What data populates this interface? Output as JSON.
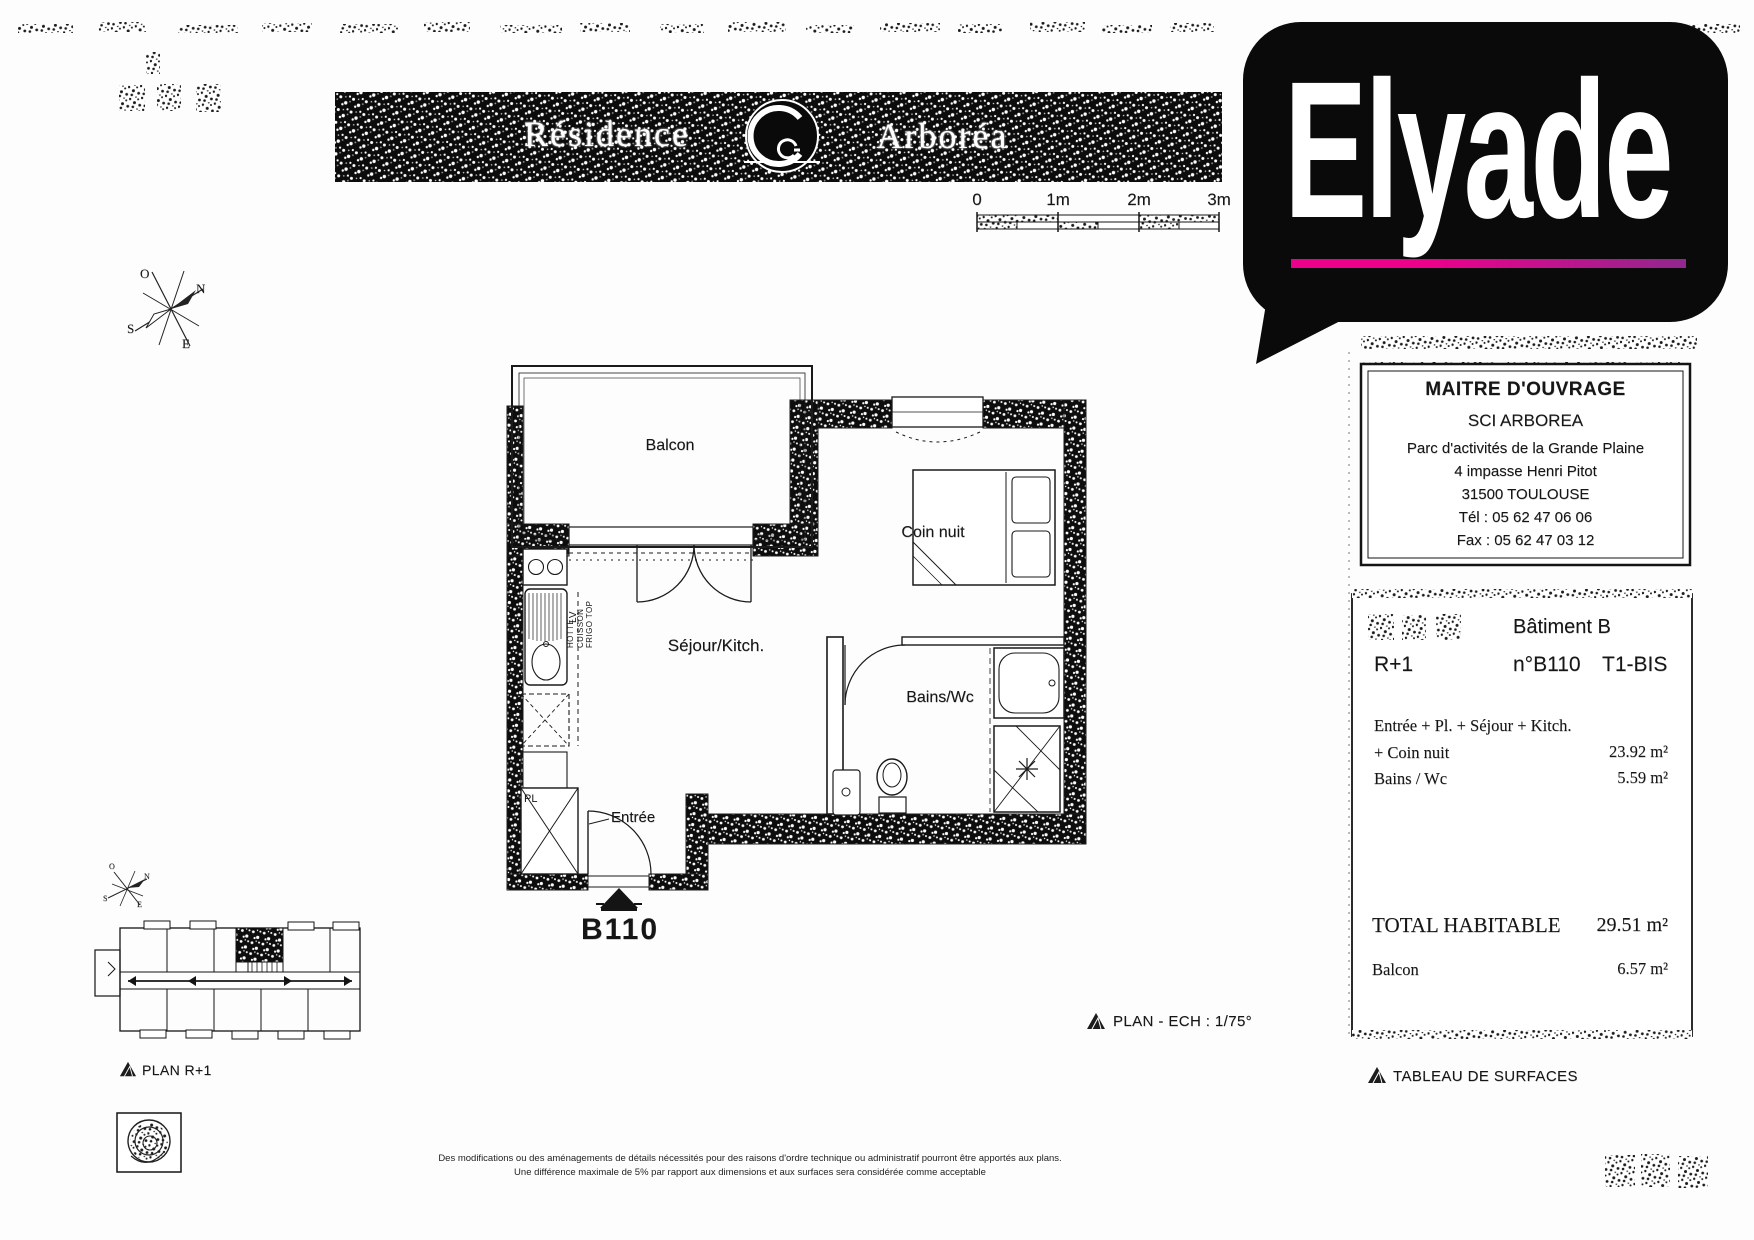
{
  "banner": {
    "residence": "Résidence",
    "arborea": "Arboréa"
  },
  "brand": {
    "name": "Elyade",
    "accent_pink": "#ec008c",
    "accent_purple": "#92278f"
  },
  "scalebar": {
    "labels": [
      "0",
      "1m",
      "2m",
      "3m"
    ]
  },
  "compass": {
    "n": "N",
    "s": "S",
    "e": "E",
    "o": "O"
  },
  "plan": {
    "balcony": "Balcon",
    "bedroom": "Coin nuit",
    "living": "Séjour/Kitch.",
    "bath": "Bains/Wc",
    "entry": "Entrée",
    "unit": "B110",
    "kitchen_hood": "HOTTE",
    "kitchen_cooktop": "CUISSON",
    "kitchen_fridge": "FRIGO TOP",
    "dishwasher": "LV",
    "closet": "PL"
  },
  "captions": {
    "plan_scale": "PLAN - ECH : 1/75°",
    "plan_floor": "PLAN R+1",
    "surface_table": "TABLEAU DE SURFACES"
  },
  "owner_box": {
    "title": "MAITRE D'OUVRAGE",
    "company": "SCI ARBOREA",
    "address1": "Parc d'activités de la Grande Plaine",
    "address2": "4 impasse Henri Pitot",
    "address3": "31500 TOULOUSE",
    "phone": "Tél : 05 62 47 06 06",
    "fax": "Fax : 05 62 47 03 12"
  },
  "surface_table": {
    "building": "Bâtiment B",
    "floor": "R+1",
    "unit": "n°B110",
    "type": "T1-BIS",
    "rows": [
      {
        "label": "Entrée + Pl. + Séjour + Kitch.",
        "value": ""
      },
      {
        "label": "+ Coin nuit",
        "value": "23.92 m²"
      },
      {
        "label": "Bains / Wc",
        "value": "5.59 m²"
      }
    ],
    "total_label": "TOTAL HABITABLE",
    "total_value": "29.51 m²",
    "balcony_label": "Balcon",
    "balcony_value": "6.57 m²"
  },
  "disclaimer": {
    "line1": "Des modifications ou des aménagements de détails nécessités pour des raisons d'ordre technique ou administratif pourront être apportés aux plans.",
    "line2": "Une différence maximale de 5% par rapport aux dimensions et aux surfaces sera considérée comme acceptable"
  }
}
